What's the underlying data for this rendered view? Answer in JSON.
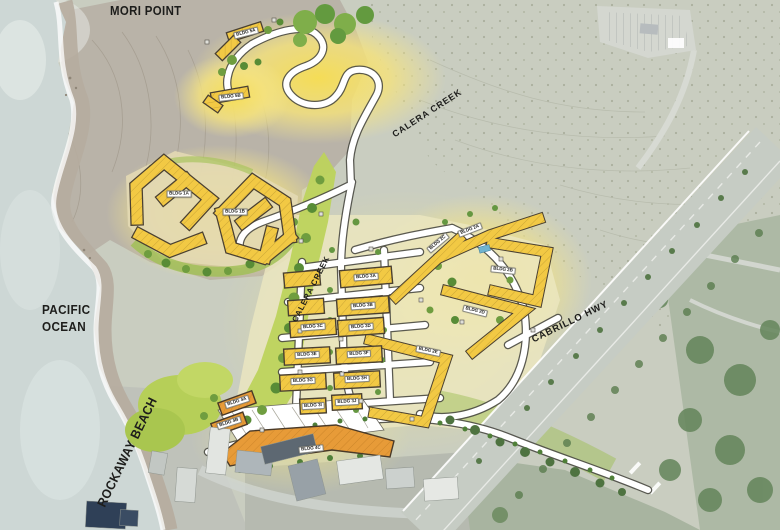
{
  "map": {
    "labels": {
      "mori_point": "MORI POINT",
      "pacific_line1": "PACIFIC",
      "pacific_line2": "OCEAN",
      "rockaway_beach": "ROCKAWAY BEACH",
      "calera_creek_upper": "CALERA CREEK",
      "calera_creek_lower": "CALERA CREEK",
      "cabrillo_hwy": "CABRILLO HWY"
    },
    "colors": {
      "ocean": "#cdd7d5",
      "land": "#c9cdc0",
      "headland": "#b7b1a6",
      "glow_yellow": "#f8df52",
      "building_yellow": "#f2c944",
      "building_orange": "#e79b38",
      "creek_green": "#bdd35c",
      "tree_green": "#6f9d3f",
      "highway_gray": "#c6ccc4",
      "road_white": "#ffffff",
      "text": "#1d1d1b"
    }
  },
  "buildings": [
    {
      "id": "5A",
      "label": "BLDG 5A"
    },
    {
      "id": "5B",
      "label": "BLDG 5B"
    },
    {
      "id": "1A",
      "label": "BLDG 1A"
    },
    {
      "id": "1B",
      "label": "BLDG 1B"
    },
    {
      "id": "2A",
      "label": "BLDG 2A"
    },
    {
      "id": "2B",
      "label": "BLDG 2B"
    },
    {
      "id": "2C",
      "label": "BLDG 2C"
    },
    {
      "id": "2D",
      "label": "BLDG 2D"
    },
    {
      "id": "2E",
      "label": "BLDG 2E"
    },
    {
      "id": "3A",
      "label": "BLDG 3A"
    },
    {
      "id": "3B",
      "label": "BLDG 3B"
    },
    {
      "id": "3C",
      "label": "BLDG 3C"
    },
    {
      "id": "3D",
      "label": "BLDG 3D"
    },
    {
      "id": "3E",
      "label": "BLDG 3E"
    },
    {
      "id": "3F",
      "label": "BLDG 3F"
    },
    {
      "id": "3G",
      "label": "BLDG 3G"
    },
    {
      "id": "3H",
      "label": "BLDG 3H"
    },
    {
      "id": "3I",
      "label": "BLDG 3I"
    },
    {
      "id": "3J",
      "label": "BLDG 3J"
    },
    {
      "id": "4A",
      "label": "BLDG 4A"
    },
    {
      "id": "4B",
      "label": "BLDG 4B"
    },
    {
      "id": "4C",
      "label": "BLDG 4C"
    }
  ]
}
